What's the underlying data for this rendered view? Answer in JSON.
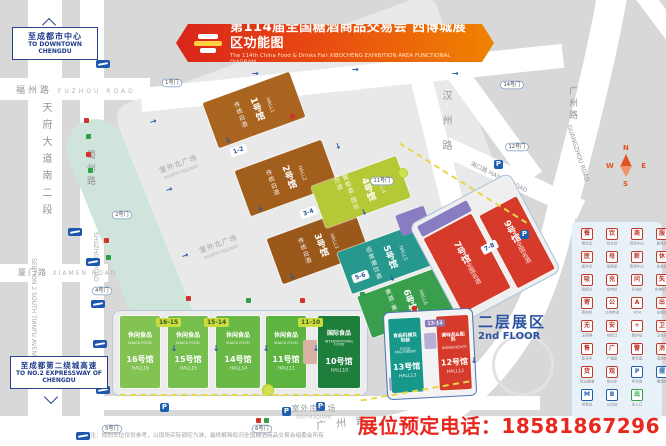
{
  "banner": {
    "title": "第114届全国糖酒商品交易会 西博城展区功能图",
    "subtitle": "The 114th China Food & Drinks Fair  XIBOCHENG EXHIBITION AREA FUNCTIONAL DIAGRAM"
  },
  "signs": {
    "downtown": {
      "zh": "至成都市中心",
      "en": "TO DOWNTOWN CHENGDU"
    },
    "expressway": {
      "zh": "至成都第二绕城高速",
      "en": "TO NO.2 EXPRESSWAY OF CHENGDU"
    }
  },
  "roads": {
    "fuzhou": {
      "zh": "福州路",
      "en": "FUZHOU ROAD"
    },
    "tianfu": {
      "zh": "天府大道南二段",
      "en": "SECTION 2 SOUTH TIANFU AVENUE"
    },
    "shuzhou": {
      "zh": "蜀州路",
      "en": "SHUZHOU ROAD"
    },
    "xiamen": {
      "zh": "厦门路",
      "en": "XIAMEN ROAD"
    },
    "hanzhou": {
      "zh": "汉州路"
    },
    "haikou": {
      "zh": "海口路",
      "en": "HAIKOU ROAD"
    },
    "guangzhou": {
      "zh": "广州路",
      "en": "GUANGZHOU ROAD"
    }
  },
  "squares": {
    "north": {
      "zh": "室外北广场",
      "en": "NORTH SQUARE"
    },
    "south": {
      "zh": "室外南广场",
      "en": "SOUTH SQUARE"
    }
  },
  "second_floor": {
    "zh": "二层展区",
    "en": "2nd FLOOR"
  },
  "gates": [
    "1号门",
    "2号门",
    "4号门",
    "5号门",
    "6号门",
    "11号门",
    "12号门",
    "14号门"
  ],
  "parking": "P",
  "compass": {
    "n": "N",
    "e": "E",
    "s": "S",
    "w": "W"
  },
  "halls": [
    {
      "num": "1号馆",
      "hall": "HALL1",
      "cat": "传统白酒",
      "color": "#a9641f"
    },
    {
      "num": "2号馆",
      "hall": "HALL2",
      "cat": "传统白酒",
      "color": "#a25e1d"
    },
    {
      "num": "3号馆",
      "hall": "HALL3",
      "cat": "传统白酒",
      "color": "#9b581b"
    },
    {
      "num": "4号馆",
      "hall": "HALL4",
      "cat": "葡萄酒·国际烈酒",
      "color": "#b5c836"
    },
    {
      "num": "5号馆",
      "hall": "HALL5",
      "cat": "低度潮饮酒",
      "color": "#27988d"
    },
    {
      "num": "6号馆",
      "hall": "HALL6",
      "cat": "黄酒·果露酒",
      "color": "#3a9f4d"
    },
    {
      "num": "7号馆",
      "hall": "HALL7",
      "cat": "全国名酒",
      "color": "#d63a2a"
    },
    {
      "num": "9号馆",
      "hall": "HALL9",
      "cat": "全国名酒",
      "color": "#d63a2a"
    },
    {
      "num": "16号馆",
      "hall": "HALL16",
      "cat": "休闲食品",
      "cat_en": "SNACK FOOD",
      "color": "#82c353"
    },
    {
      "num": "15号馆",
      "hall": "HALL15",
      "cat": "休闲食品",
      "cat_en": "SNACK FOOD",
      "color": "#76be4d"
    },
    {
      "num": "14号馆",
      "hall": "HALL14",
      "cat": "休闲食品",
      "cat_en": "SNACK FOOD",
      "color": "#6ab947"
    },
    {
      "num": "11号馆",
      "hall": "HALL11",
      "cat": "休闲食品",
      "cat_en": "SNACK FOOD",
      "color": "#5eb441"
    },
    {
      "num": "10号馆",
      "hall": "HALL10",
      "cat": "国际食品",
      "cat_en": "INTERNATIONAL FOOD",
      "color": "#1e7e3c"
    },
    {
      "num": "13号馆",
      "hall": "HALL13",
      "cat": "食品机械及包装",
      "cat_en": "FOOD MACHINERY",
      "color": "#18988b"
    },
    {
      "num": "12号馆",
      "hall": "HALL12",
      "cat": "调味品&配料",
      "cat_en": "INGREDIENTS",
      "color": "#d63a2a"
    }
  ],
  "connectors": [
    "1-2",
    "3-4",
    "5-6",
    "7-8",
    "16-15",
    "15-14",
    "11-10",
    "13-12"
  ],
  "legend": {
    "items": [
      {
        "label": "餐饮区",
        "color": "#c0392b"
      },
      {
        "label": "饮水处",
        "color": "#c0392b"
      },
      {
        "label": "商务中心",
        "color": "#c0392b"
      },
      {
        "label": "服务处",
        "color": "#c0392b"
      },
      {
        "label": "医疗点",
        "color": "#c0392b"
      },
      {
        "label": "母婴室",
        "color": "#c0392b"
      },
      {
        "label": "新闻中心",
        "color": "#c0392b"
      },
      {
        "label": "休息区",
        "color": "#c0392b"
      },
      {
        "label": "吸烟点",
        "color": "#c0392b"
      },
      {
        "label": "充电处",
        "color": "#c0392b"
      },
      {
        "label": "问询处",
        "color": "#c0392b"
      },
      {
        "label": "失物招领",
        "color": "#c0392b"
      },
      {
        "label": "寄存处",
        "color": "#c0392b"
      },
      {
        "label": "公用电话",
        "color": "#c0392b"
      },
      {
        "label": "ATM",
        "color": "#c0392b",
        "glyph": "A"
      },
      {
        "label": "出租车",
        "color": "#c0392b"
      },
      {
        "label": "无障碍",
        "color": "#c0392b"
      },
      {
        "label": "安检口",
        "color": "#c0392b"
      },
      {
        "label": "救护站",
        "color": "#c0392b",
        "glyph": "+"
      },
      {
        "label": "卫生间",
        "color": "#c0392b"
      },
      {
        "label": "售卖亭",
        "color": "#c0392b"
      },
      {
        "label": "广播室",
        "color": "#c0392b"
      },
      {
        "label": "警务室",
        "color": "#c0392b"
      },
      {
        "label": "消防栓",
        "color": "#c0392b"
      },
      {
        "label": "货运通道",
        "color": "#c0392b"
      },
      {
        "label": "观光车",
        "color": "#c0392b"
      },
      {
        "label": "停车场",
        "color": "#1f5fb0",
        "glyph": "P"
      },
      {
        "label": "摆渡车",
        "color": "#1f5fb0"
      },
      {
        "label": "地铁站",
        "color": "#1f5fb0",
        "glyph": "M"
      },
      {
        "label": "公交站",
        "color": "#1f5fb0",
        "glyph": "B"
      },
      {
        "label": "出入口",
        "color": "#2f9e44",
        "glyph": "出"
      }
    ]
  },
  "footer": {
    "note": "注：规划车位仅供参考，以现场实际调控为准，最终解释权归全国糖酒商品交易会组委会所有",
    "phone_label": "展位预定电话：",
    "phone": "18581867296"
  }
}
